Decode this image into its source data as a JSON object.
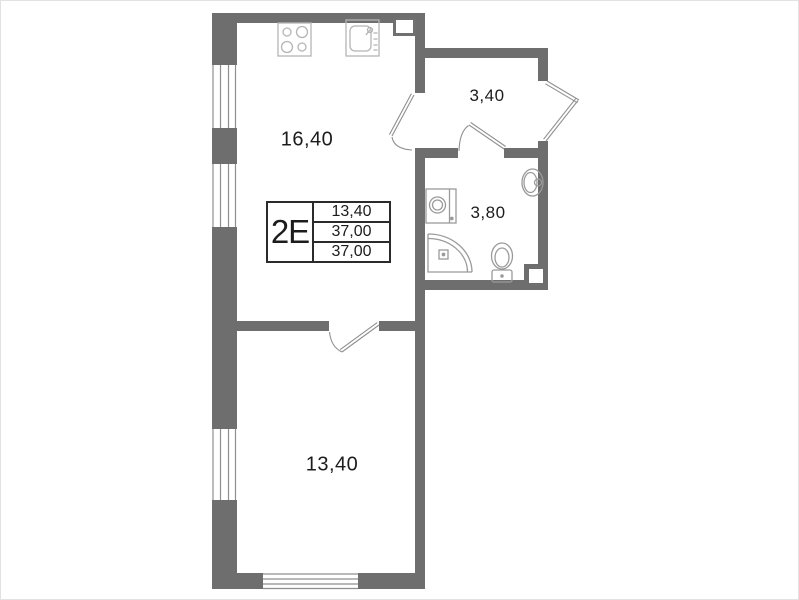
{
  "unit_box": {
    "type_label": "2E",
    "values": [
      "13,40",
      "37,00",
      "37,00"
    ]
  },
  "rooms": {
    "kitchen_living": {
      "area": "16,40"
    },
    "hallway": {
      "area": "3,40"
    },
    "bathroom": {
      "area": "3,80"
    },
    "bedroom": {
      "area": "13,40"
    }
  },
  "fixtures": [
    "stove-icon",
    "kitchen-sink-icon",
    "washing-machine-icon",
    "bath-sink-icon",
    "shower-icon",
    "toilet-icon"
  ],
  "colors": {
    "wall": "#6e6e6e",
    "fixture_light": "#b5b5b5",
    "fixture": "#9a9a9a",
    "door_line": "#909090",
    "window_line": "#8f8f8f",
    "text": "#1c1c1c",
    "label_border": "#2b2b2b"
  }
}
